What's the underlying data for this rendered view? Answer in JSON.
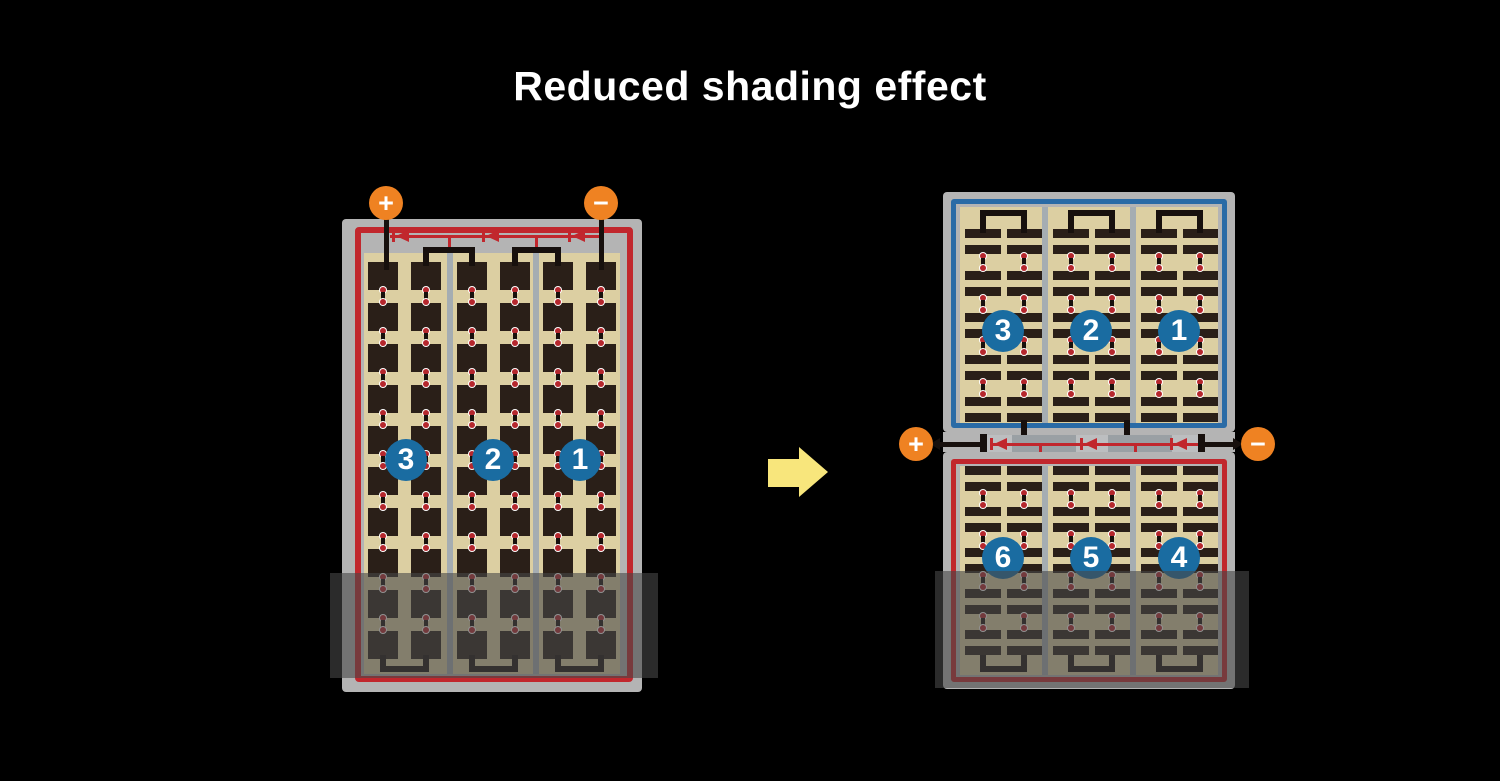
{
  "title": "Reduced shading effect",
  "left_panel": {
    "terminal_positive": "+",
    "terminal_negative": "−",
    "string_labels": [
      "3",
      "2",
      "1"
    ],
    "bypass_diode_count": 3
  },
  "right_panel": {
    "upper_half_string_labels": [
      "3",
      "2",
      "1"
    ],
    "lower_half_string_labels": [
      "6",
      "5",
      "4"
    ],
    "terminal_positive": "+",
    "terminal_negative": "−",
    "bypass_diode_count": 3
  },
  "colors": {
    "background": "#000000",
    "frame_gray": "#b4b4b4",
    "divider_gray": "#a5adb2",
    "panel_tan": "#dccfa2",
    "cell_dark": "#2a1f18",
    "wire_black": "#17100d",
    "border_red": "#c1272d",
    "border_blue": "#2a6ba6",
    "diode_red": "#c1272d",
    "dot_red": "#b5272d",
    "terminal_orange": "#ef8222",
    "number_circle_blue": "#1a6ca1",
    "number_text": "#ffffff",
    "arrow_yellow": "#f8e67c",
    "bus_gray_light": "#bcbec0",
    "bus_gray_dark": "#9aa0a4",
    "shade_overlay": "rgba(72,72,72,0.6)"
  }
}
